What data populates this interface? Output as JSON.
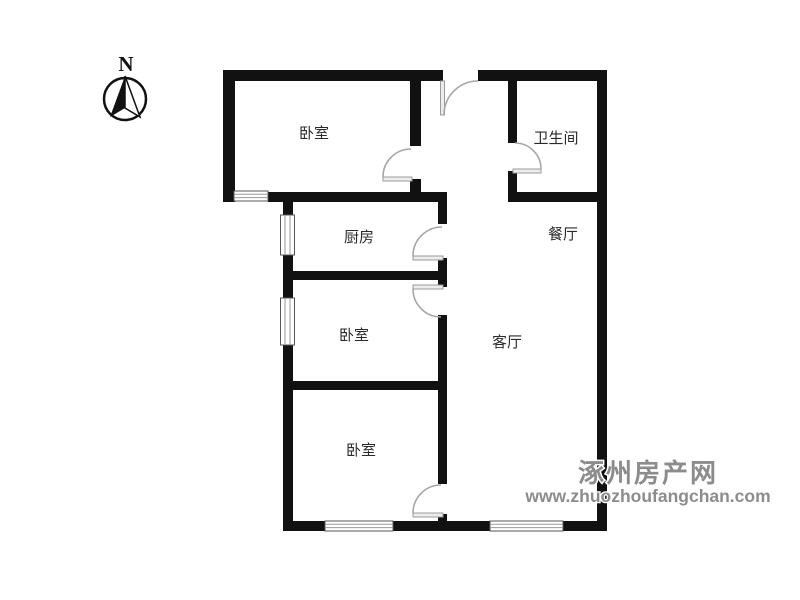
{
  "compass": {
    "north_label": "N"
  },
  "rooms": {
    "bedroom_top": "卧室",
    "bathroom": "卫生间",
    "kitchen": "厨房",
    "dining": "餐厅",
    "bedroom_middle": "卧室",
    "living": "客厅",
    "bedroom_bottom": "卧室"
  },
  "watermark": {
    "site_name": "涿州房产网",
    "site_url": "www.zhuozhoufangchan.com"
  },
  "colors": {
    "wall": "#111111",
    "door_line": "#a6a6a6",
    "label_text": "#2b2b2b",
    "watermark_text": "#8c8c8c",
    "background": "#ffffff"
  }
}
